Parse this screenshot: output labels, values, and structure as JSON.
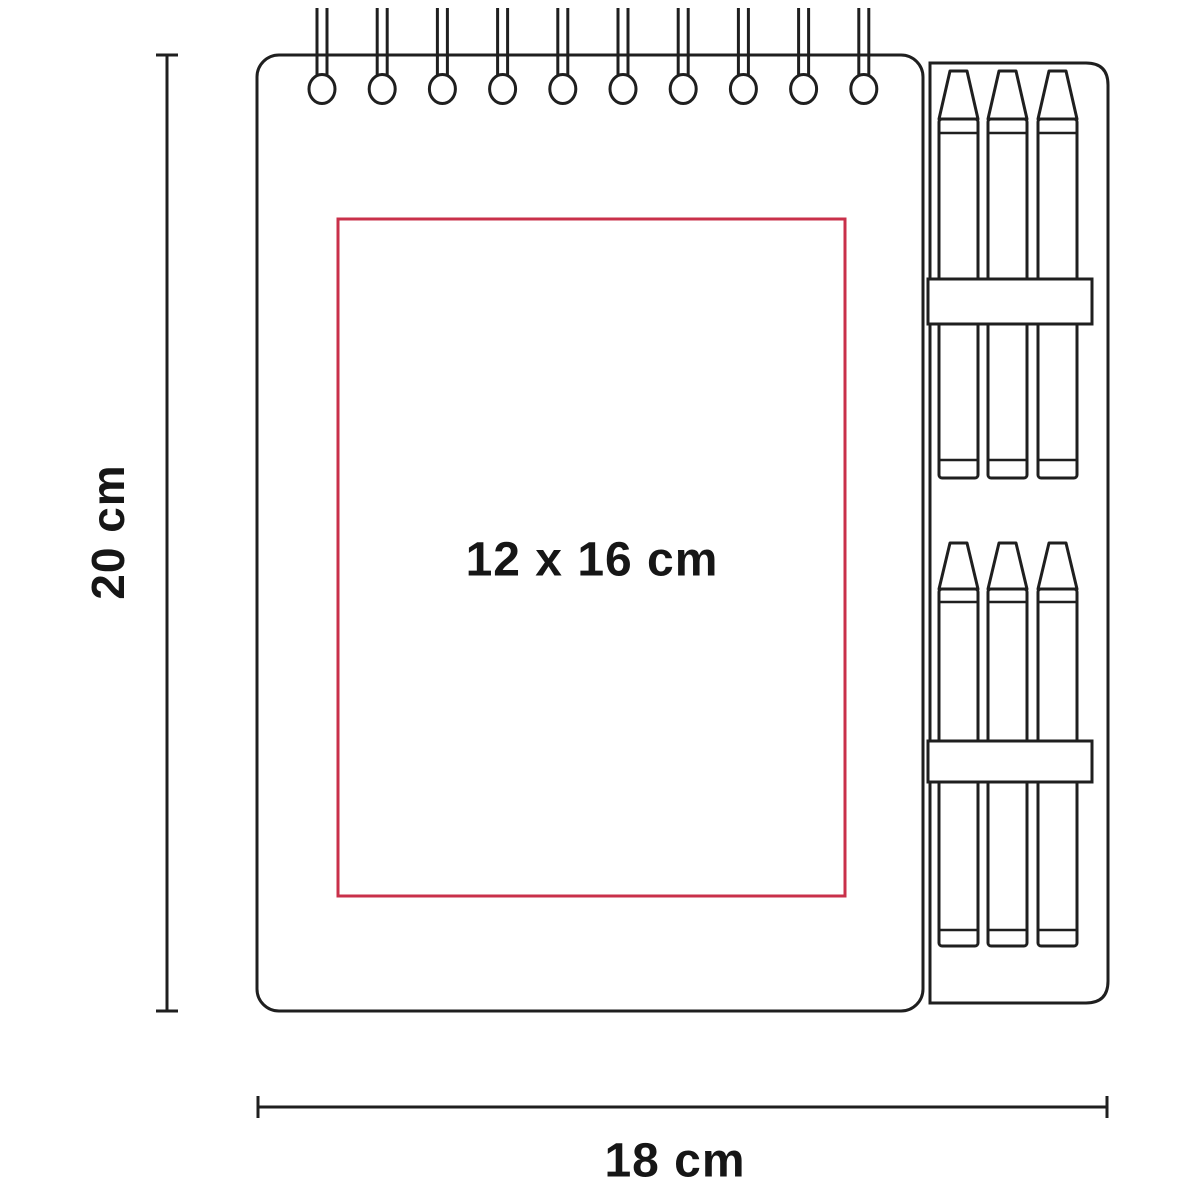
{
  "diagram": {
    "labels": {
      "height": "20 cm",
      "width": "18 cm",
      "imprint_area": "12 x 16 cm"
    },
    "colors": {
      "line": "#1f1f1f",
      "imprint_box": "#c9304a",
      "text": "#161616",
      "background": "#ffffff"
    },
    "spiral_rings": 10,
    "crayon_groups": 2,
    "crayons_per_group": 3
  }
}
